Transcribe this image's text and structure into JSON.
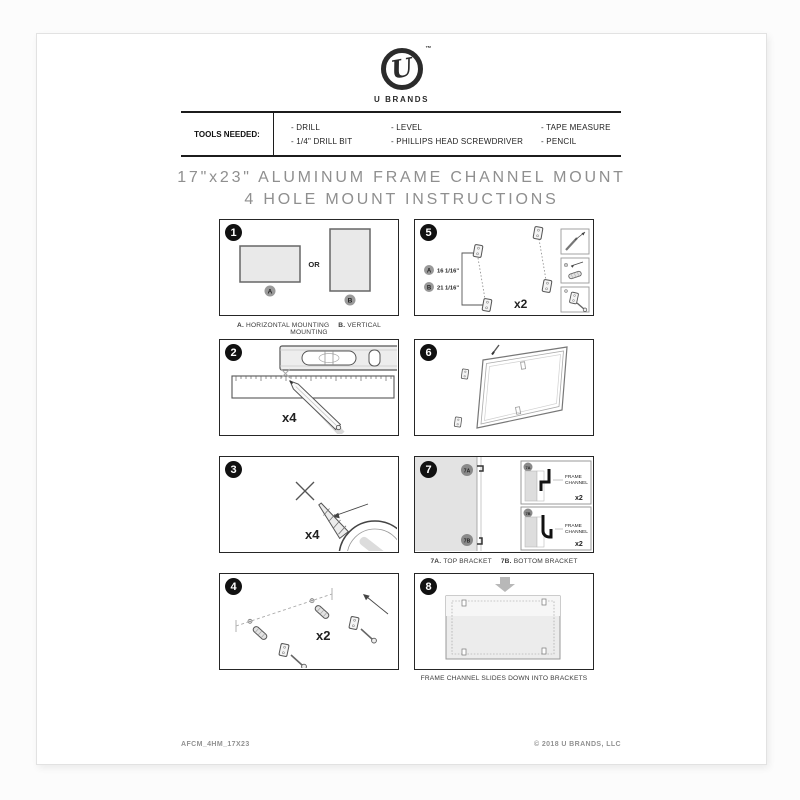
{
  "brand": {
    "logo_letter": "U",
    "trademark": "™",
    "name": "U BRANDS"
  },
  "tools": {
    "label": "TOOLS NEEDED:",
    "col1": [
      "- DRILL",
      "- 1/4\" DRILL BIT"
    ],
    "col2": [
      "- LEVEL",
      "- PHILLIPS HEAD SCREWDRIVER"
    ],
    "col3": [
      "- TAPE MEASURE",
      "- PENCIL"
    ]
  },
  "title": {
    "line1": "17\"x23\" ALUMINUM FRAME CHANNEL MOUNT",
    "line2": "4 HOLE MOUNT INSTRUCTIONS"
  },
  "steps": {
    "s1": {
      "number": "1",
      "or_label": "OR",
      "marker_a": "A",
      "marker_b": "B",
      "caption_a_key": "A.",
      "caption_a": "HORIZONTAL MOUNTING",
      "caption_b_key": "B.",
      "caption_b": "VERTICAL MOUNTING"
    },
    "s2": {
      "number": "2",
      "qty": "x4"
    },
    "s3": {
      "number": "3",
      "qty": "x4"
    },
    "s4": {
      "number": "4",
      "qty": "x2"
    },
    "s5": {
      "number": "5",
      "marker_a": "A",
      "dim_a": "16 1/16\"",
      "marker_b": "B",
      "dim_b": "21 1/16\"",
      "qty": "x2"
    },
    "s6": {
      "number": "6"
    },
    "s7": {
      "number": "7",
      "badge_a": "7A",
      "badge_b": "7B",
      "detail_label_1": "FRAME",
      "detail_label_2": "CHANNEL",
      "detail_qty": "x2",
      "caption_a_key": "7A.",
      "caption_a": "TOP BRACKET",
      "caption_b_key": "7B.",
      "caption_b": "BOTTOM BRACKET"
    },
    "s8": {
      "number": "8",
      "caption": "FRAME CHANNEL SLIDES DOWN INTO BRACKETS"
    }
  },
  "footer": {
    "left": "AFCM_4HM_17X23",
    "right": "© 2018 U BRANDS, LLC"
  },
  "colors": {
    "ink": "#1c1c1c",
    "title_gray": "#8f8f8f",
    "panel_fill": "#e9e9e9",
    "badge": "#111111"
  },
  "icons": {
    "logo": "u-script-circle-icon",
    "level": "bubble-level-icon",
    "ruler": "ruler-icon",
    "pencil": "pencil-icon",
    "drill_bit": "drill-bit-icon",
    "drill_chuck": "drill-chuck-icon",
    "wall_anchor": "wall-anchor-icon",
    "screw": "screw-icon",
    "bracket": "mounting-bracket-icon",
    "frame": "frame-icon",
    "down_arrow": "down-arrow-icon"
  }
}
